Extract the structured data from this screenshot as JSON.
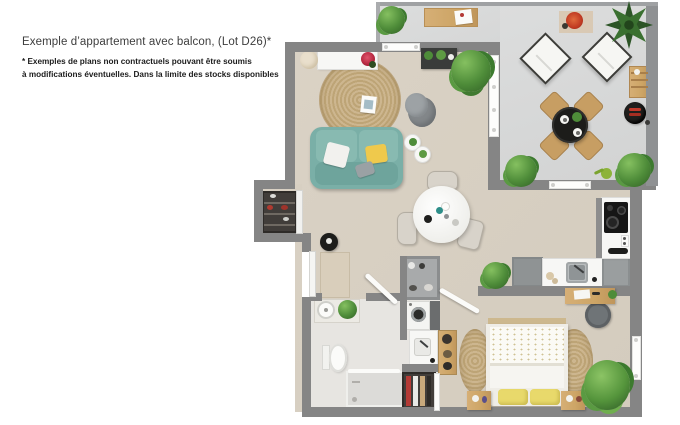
{
  "document": {
    "title": "Exemple d’appartement avec balcon, (Lot D26)*",
    "footnote_line1": "* Exemples de plans non contractuels pouvant être soumis",
    "footnote_line2": "à modifications éventuelles. Dans la limite des stocks disponibles"
  },
  "colors": {
    "wall": "#858585",
    "floor": "#d8d0c2",
    "balconyfloor": "#d6d7d7",
    "bathfloor": "#e7e5e1",
    "sofa": "#7aafa7",
    "rug": "#c9b28b",
    "wood": "#cda566",
    "plant": "#4e8c39",
    "plantdark": "#2c5426",
    "white": "#f7f7f5",
    "black": "#1d1d1b",
    "yellow": "#efc94c",
    "bedyellow": "#e8d96b",
    "red": "#c0392b"
  }
}
